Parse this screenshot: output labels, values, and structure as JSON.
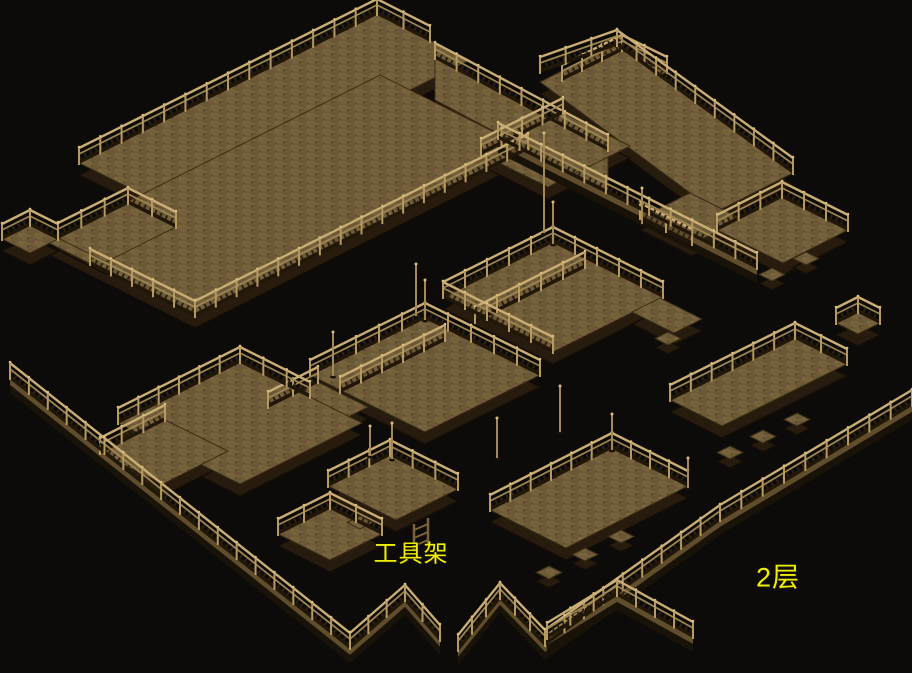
{
  "scene": {
    "description": "isometric wooden scaffolding map, second floor",
    "width": 912,
    "height": 673
  },
  "labels": {
    "tool_rack": {
      "text": "工具架",
      "x": 411,
      "y": 551,
      "font_size": 24
    },
    "floor": {
      "text": "2层",
      "x": 778,
      "y": 575,
      "font_size": 27
    }
  },
  "palette": {
    "background": "#0c0b0a",
    "label_color": "#f0ee00",
    "floor_base": "#6b5836",
    "floor_light": "#75613c",
    "floor_dot_light": "#8b764a",
    "floor_dot_dark": "#4d3d20",
    "face_edge": "#3a2c15",
    "side": "#271b0d",
    "side_dark": "#140d06",
    "rail_light": "#c9ad74",
    "rail_mid": "#9d8451",
    "rail_band": "#2c2010",
    "post": "#b69a60",
    "knob": "#d8bc80",
    "base_line": "#211708",
    "plank": "#5f4d2c",
    "plank_shadow": "#191208",
    "mast": "#a38955",
    "rack_wood": "#7a6335"
  },
  "map": {
    "platforms": [
      {
        "id": "a-upper",
        "pts": [
          [
            377,
            14
          ],
          [
            470,
            60
          ],
          [
            172,
            209
          ],
          [
            79,
            163
          ]
        ]
      },
      {
        "id": "a-big",
        "pts": [
          [
            380,
            75
          ],
          [
            528,
            149
          ],
          [
            195,
            316
          ],
          [
            47,
            242
          ]
        ]
      },
      {
        "id": "a-west",
        "pts": [
          [
            128,
            203
          ],
          [
            176,
            227
          ],
          [
            106,
            262
          ],
          [
            58,
            238
          ]
        ]
      },
      {
        "id": "bridge",
        "pts": [
          [
            435,
            58
          ],
          [
            608,
            150
          ],
          [
            608,
            192
          ],
          [
            435,
            100
          ]
        ]
      },
      {
        "id": "b-top",
        "pts": [
          [
            622,
            50
          ],
          [
            667,
            72
          ],
          [
            607,
            102
          ],
          [
            562,
            80
          ]
        ]
      },
      {
        "id": "b-main",
        "pts": [
          [
            617,
            43
          ],
          [
            793,
            173
          ],
          [
            716,
            212
          ],
          [
            540,
            82
          ]
        ]
      },
      {
        "id": "b-left",
        "pts": [
          [
            563,
            113
          ],
          [
            630,
            146
          ],
          [
            548,
            187
          ],
          [
            481,
            154
          ]
        ]
      },
      {
        "id": "b-south",
        "pts": [
          [
            690,
            193
          ],
          [
            742,
            219
          ],
          [
            692,
            244
          ],
          [
            640,
            218
          ]
        ]
      },
      {
        "id": "c",
        "pts": [
          [
            782,
            197
          ],
          [
            848,
            230
          ],
          [
            783,
            263
          ],
          [
            717,
            230
          ]
        ]
      },
      {
        "id": "c2",
        "pts": [
          [
            858,
            312
          ],
          [
            880,
            323
          ],
          [
            858,
            334
          ],
          [
            836,
            323
          ]
        ]
      },
      {
        "id": "m2",
        "pts": [
          [
            553,
            242
          ],
          [
            663,
            297
          ],
          [
            553,
            352
          ],
          [
            443,
            297
          ]
        ]
      },
      {
        "id": "m2e",
        "pts": [
          [
            660,
            298
          ],
          [
            702,
            319
          ],
          [
            674,
            333
          ],
          [
            632,
            312
          ]
        ]
      },
      {
        "id": "m1",
        "pts": [
          [
            425,
            318
          ],
          [
            540,
            375
          ],
          [
            425,
            432
          ],
          [
            310,
            375
          ]
        ]
      },
      {
        "id": "m1w",
        "pts": [
          [
            318,
            382
          ],
          [
            368,
            407
          ],
          [
            318,
            432
          ],
          [
            268,
            407
          ]
        ]
      },
      {
        "id": "f",
        "pts": [
          [
            795,
            338
          ],
          [
            847,
            364
          ],
          [
            722,
            426
          ],
          [
            670,
            400
          ]
        ]
      },
      {
        "id": "d-main",
        "pts": [
          [
            240,
            362
          ],
          [
            362,
            423
          ],
          [
            240,
            484
          ],
          [
            118,
            423
          ]
        ]
      },
      {
        "id": "d-west",
        "pts": [
          [
            165,
            420
          ],
          [
            228,
            451
          ],
          [
            163,
            484
          ],
          [
            100,
            453
          ]
        ]
      },
      {
        "id": "d-tail",
        "pts": [
          [
            390,
            455
          ],
          [
            458,
            489
          ],
          [
            396,
            520
          ],
          [
            328,
            486
          ]
        ]
      },
      {
        "id": "d-stail",
        "pts": [
          [
            330,
            508
          ],
          [
            382,
            534
          ],
          [
            330,
            560
          ],
          [
            278,
            534
          ]
        ]
      },
      {
        "id": "e",
        "pts": [
          [
            612,
            448
          ],
          [
            688,
            486
          ],
          [
            566,
            548
          ],
          [
            490,
            510
          ]
        ]
      },
      {
        "id": "rf2",
        "pts": [
          [
            30,
            225
          ],
          [
            58,
            239
          ],
          [
            30,
            253
          ],
          [
            2,
            239
          ]
        ]
      }
    ],
    "tabs": [
      [
        763,
        430
      ],
      [
        797,
        413
      ],
      [
        730,
        446
      ],
      [
        585,
        548
      ],
      [
        621,
        530
      ],
      [
        549,
        566
      ],
      [
        772,
        268
      ],
      [
        806,
        252
      ],
      [
        360,
        516
      ],
      [
        668,
        332
      ]
    ],
    "railings": [
      {
        "pts": [
          [
            79,
            163
          ],
          [
            377,
            14
          ],
          [
            430,
            41
          ]
        ]
      },
      {
        "pts": [
          [
            435,
            58
          ],
          [
            608,
            150
          ]
        ]
      },
      {
        "pts": [
          [
            528,
            149
          ],
          [
            195,
            316
          ]
        ]
      },
      {
        "pts": [
          [
            90,
            264
          ],
          [
            195,
            316
          ]
        ]
      },
      {
        "pts": [
          [
            58,
            238
          ],
          [
            128,
            203
          ],
          [
            176,
            227
          ]
        ]
      },
      {
        "pts": [
          [
            481,
            154
          ],
          [
            563,
            113
          ]
        ]
      },
      {
        "pts": [
          [
            562,
            80
          ],
          [
            622,
            50
          ],
          [
            667,
            72
          ]
        ]
      },
      {
        "pts": [
          [
            540,
            72
          ],
          [
            617,
            45
          ],
          [
            793,
            173
          ]
        ]
      },
      {
        "pts": [
          [
            640,
            218
          ],
          [
            692,
            244
          ]
        ]
      },
      {
        "pts": [
          [
            717,
            230
          ],
          [
            782,
            197
          ],
          [
            848,
            230
          ]
        ]
      },
      {
        "pts": [
          [
            836,
            323
          ],
          [
            858,
            312
          ],
          [
            880,
            323
          ]
        ]
      },
      {
        "pts": [
          [
            443,
            297
          ],
          [
            553,
            242
          ],
          [
            663,
            297
          ]
        ]
      },
      {
        "pts": [
          [
            475,
            322
          ],
          [
            585,
            267
          ]
        ]
      },
      {
        "pts": [
          [
            443,
            297
          ],
          [
            553,
            352
          ]
        ]
      },
      {
        "pts": [
          [
            310,
            375
          ],
          [
            425,
            318
          ],
          [
            540,
            375
          ]
        ]
      },
      {
        "pts": [
          [
            340,
            392
          ],
          [
            445,
            340
          ]
        ]
      },
      {
        "pts": [
          [
            268,
            407
          ],
          [
            318,
            382
          ]
        ]
      },
      {
        "pts": [
          [
            670,
            400
          ],
          [
            795,
            338
          ],
          [
            847,
            364
          ]
        ]
      },
      {
        "pts": [
          [
            118,
            423
          ],
          [
            240,
            362
          ],
          [
            310,
            397
          ]
        ]
      },
      {
        "pts": [
          [
            100,
            453
          ],
          [
            165,
            420
          ]
        ]
      },
      {
        "pts": [
          [
            328,
            486
          ],
          [
            390,
            455
          ],
          [
            458,
            489
          ]
        ]
      },
      {
        "pts": [
          [
            278,
            534
          ],
          [
            330,
            508
          ],
          [
            382,
            534
          ]
        ]
      },
      {
        "pts": [
          [
            490,
            510
          ],
          [
            612,
            448
          ],
          [
            688,
            486
          ]
        ]
      },
      {
        "pts": [
          [
            2,
            239
          ],
          [
            30,
            225
          ],
          [
            58,
            239
          ]
        ]
      },
      {
        "pts": [
          [
            10,
            378
          ],
          [
            350,
            648
          ],
          [
            405,
            600
          ],
          [
            440,
            640
          ]
        ],
        "low": true
      },
      {
        "pts": [
          [
            912,
            405
          ],
          [
            720,
            520
          ],
          [
            545,
            645
          ],
          [
            500,
            598
          ],
          [
            458,
            650
          ]
        ],
        "low": true
      },
      {
        "pts": [
          [
            547,
            638
          ],
          [
            617,
            595
          ],
          [
            693,
            637
          ]
        ],
        "low": true
      },
      {
        "pts": [
          [
            498,
            138
          ],
          [
            757,
            268
          ]
        ],
        "low": true
      }
    ],
    "masts": [
      [
        544,
        233,
        100
      ],
      [
        416,
        316,
        52
      ],
      [
        333,
        376,
        44
      ],
      [
        612,
        450,
        36
      ],
      [
        560,
        432,
        46
      ],
      [
        497,
        458,
        40
      ],
      [
        392,
        459,
        36
      ],
      [
        642,
        224,
        36
      ],
      [
        553,
        244,
        42
      ],
      [
        425,
        320,
        40
      ],
      [
        688,
        488,
        30
      ],
      [
        370,
        456,
        30
      ]
    ],
    "tool_rack_object": {
      "x": 421,
      "y": 535
    }
  }
}
